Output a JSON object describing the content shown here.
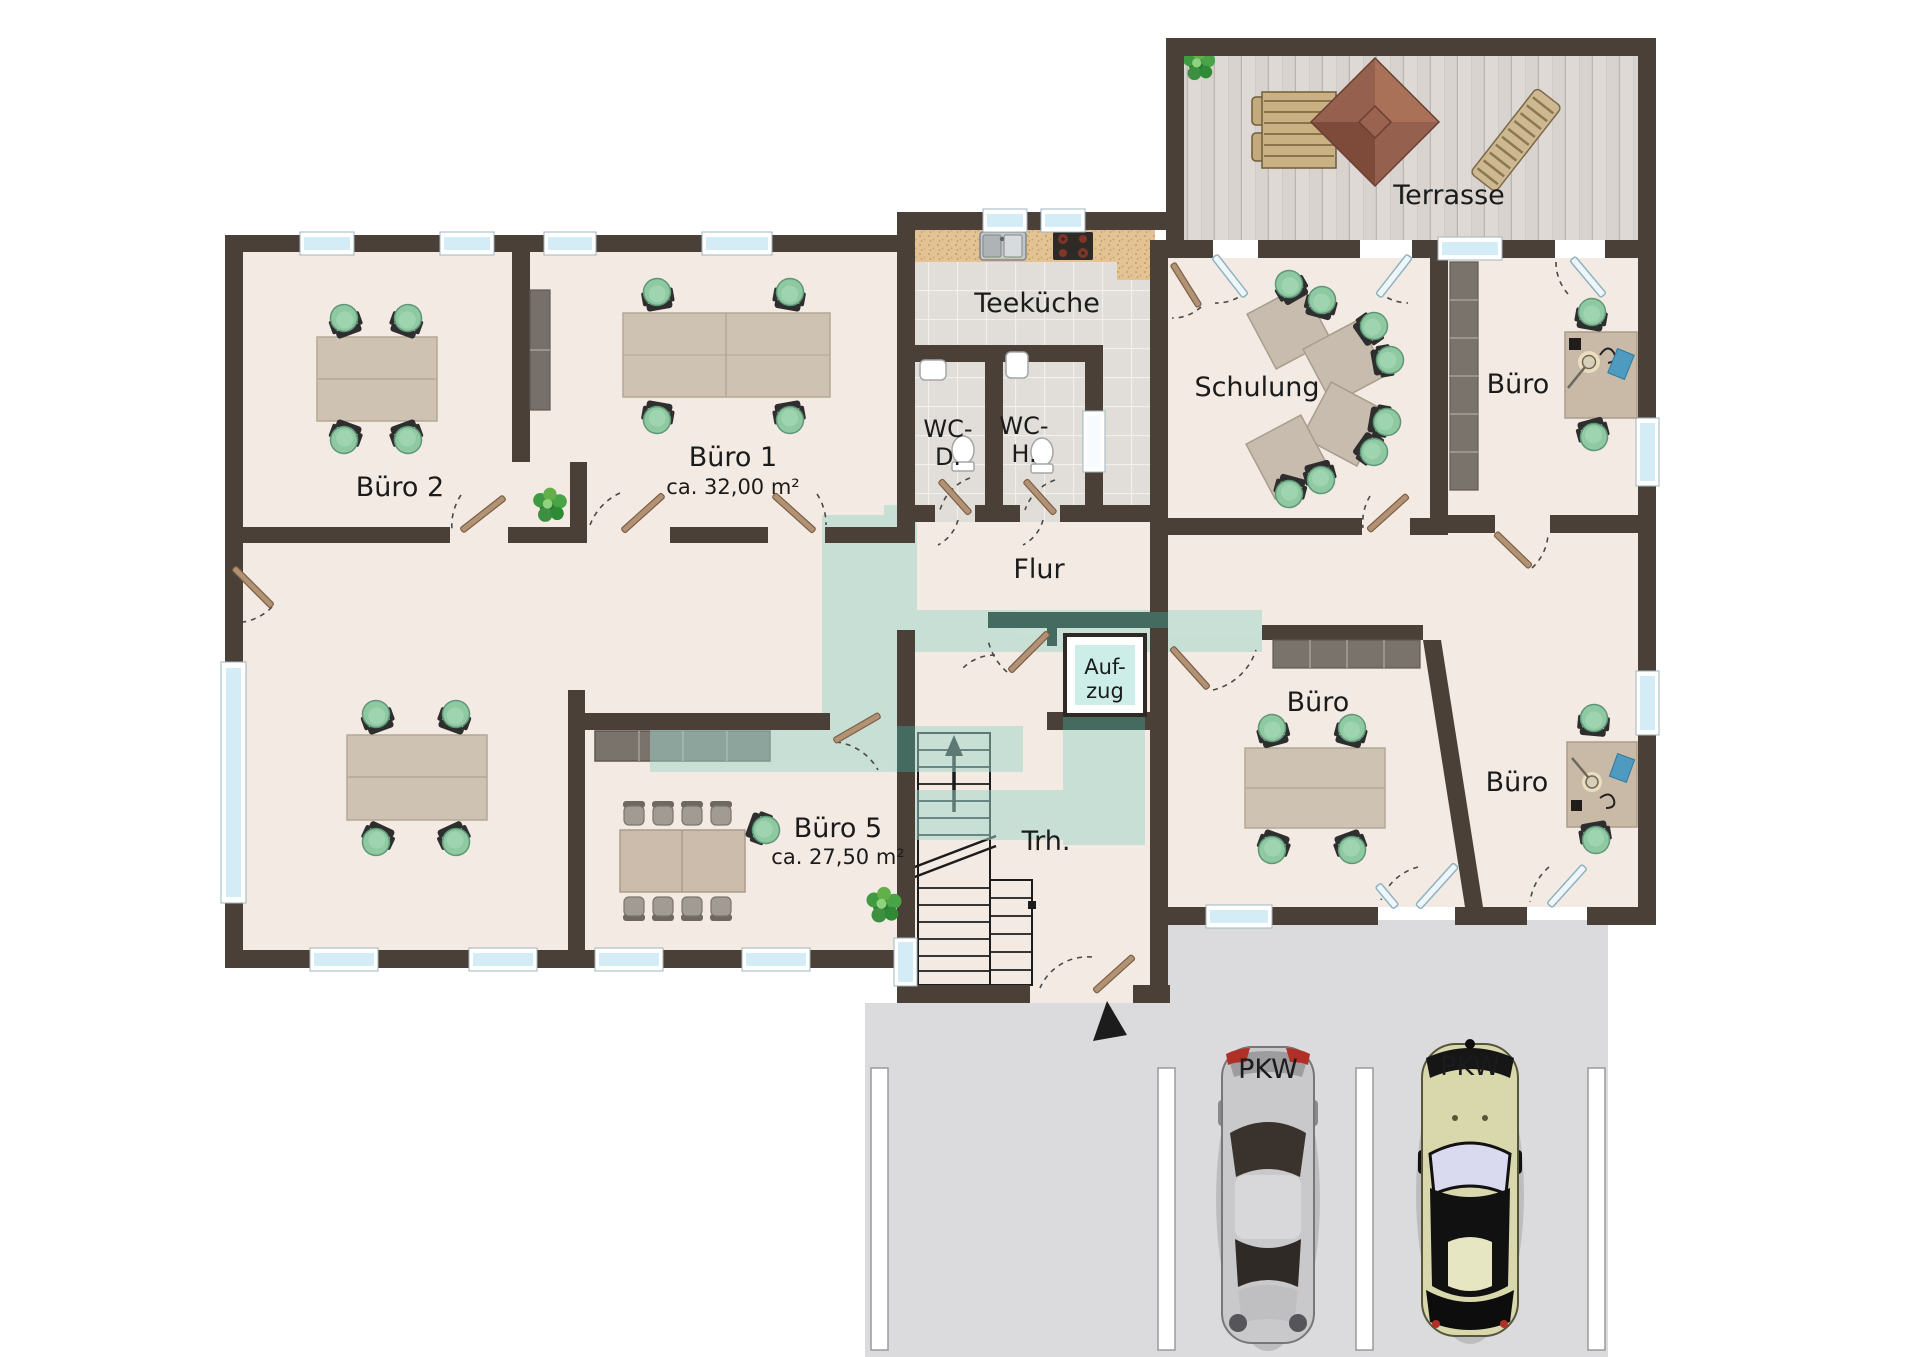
{
  "plan": {
    "type": "floor-plan",
    "labels": {
      "terrasse": "Terrasse",
      "teekueche": "Teeküche",
      "wc_d": {
        "line1": "WC-",
        "line2": "D."
      },
      "wc_h": {
        "line1": "WC-",
        "line2": "H."
      },
      "schulung": "Schulung",
      "buero_oben_rechts": "Büro",
      "buero_2": "Büro 2",
      "buero_1": {
        "name": "Büro 1",
        "area": "ca. 32,00 m²"
      },
      "flur": "Flur",
      "aufzug": {
        "line1": "Auf-",
        "line2": "zug"
      },
      "buero_mitte": "Büro",
      "buero_unten_rechts": "Büro",
      "buero_5": {
        "name": "Büro 5",
        "area": "ca. 27,50 m²"
      },
      "treppenhaus": "Trh.",
      "pkw_1": "PKW",
      "pkw_2": "PKW"
    },
    "colors": {
      "wall": "#4b4037",
      "floor": "#f3eae3",
      "tile": "#e1ded9",
      "deck": "#d8d3cf",
      "parking": "#dbdbdd",
      "highlight_teal": "#9fd6cb",
      "elevator_fill": "#cdeee8",
      "window_glass": "#d3ecf6",
      "door_wood": "#b29274",
      "chair_green": "#8fc9a2",
      "desk": "#cec2b2",
      "parasol": "#96604e",
      "counter": "#e3c294"
    }
  }
}
